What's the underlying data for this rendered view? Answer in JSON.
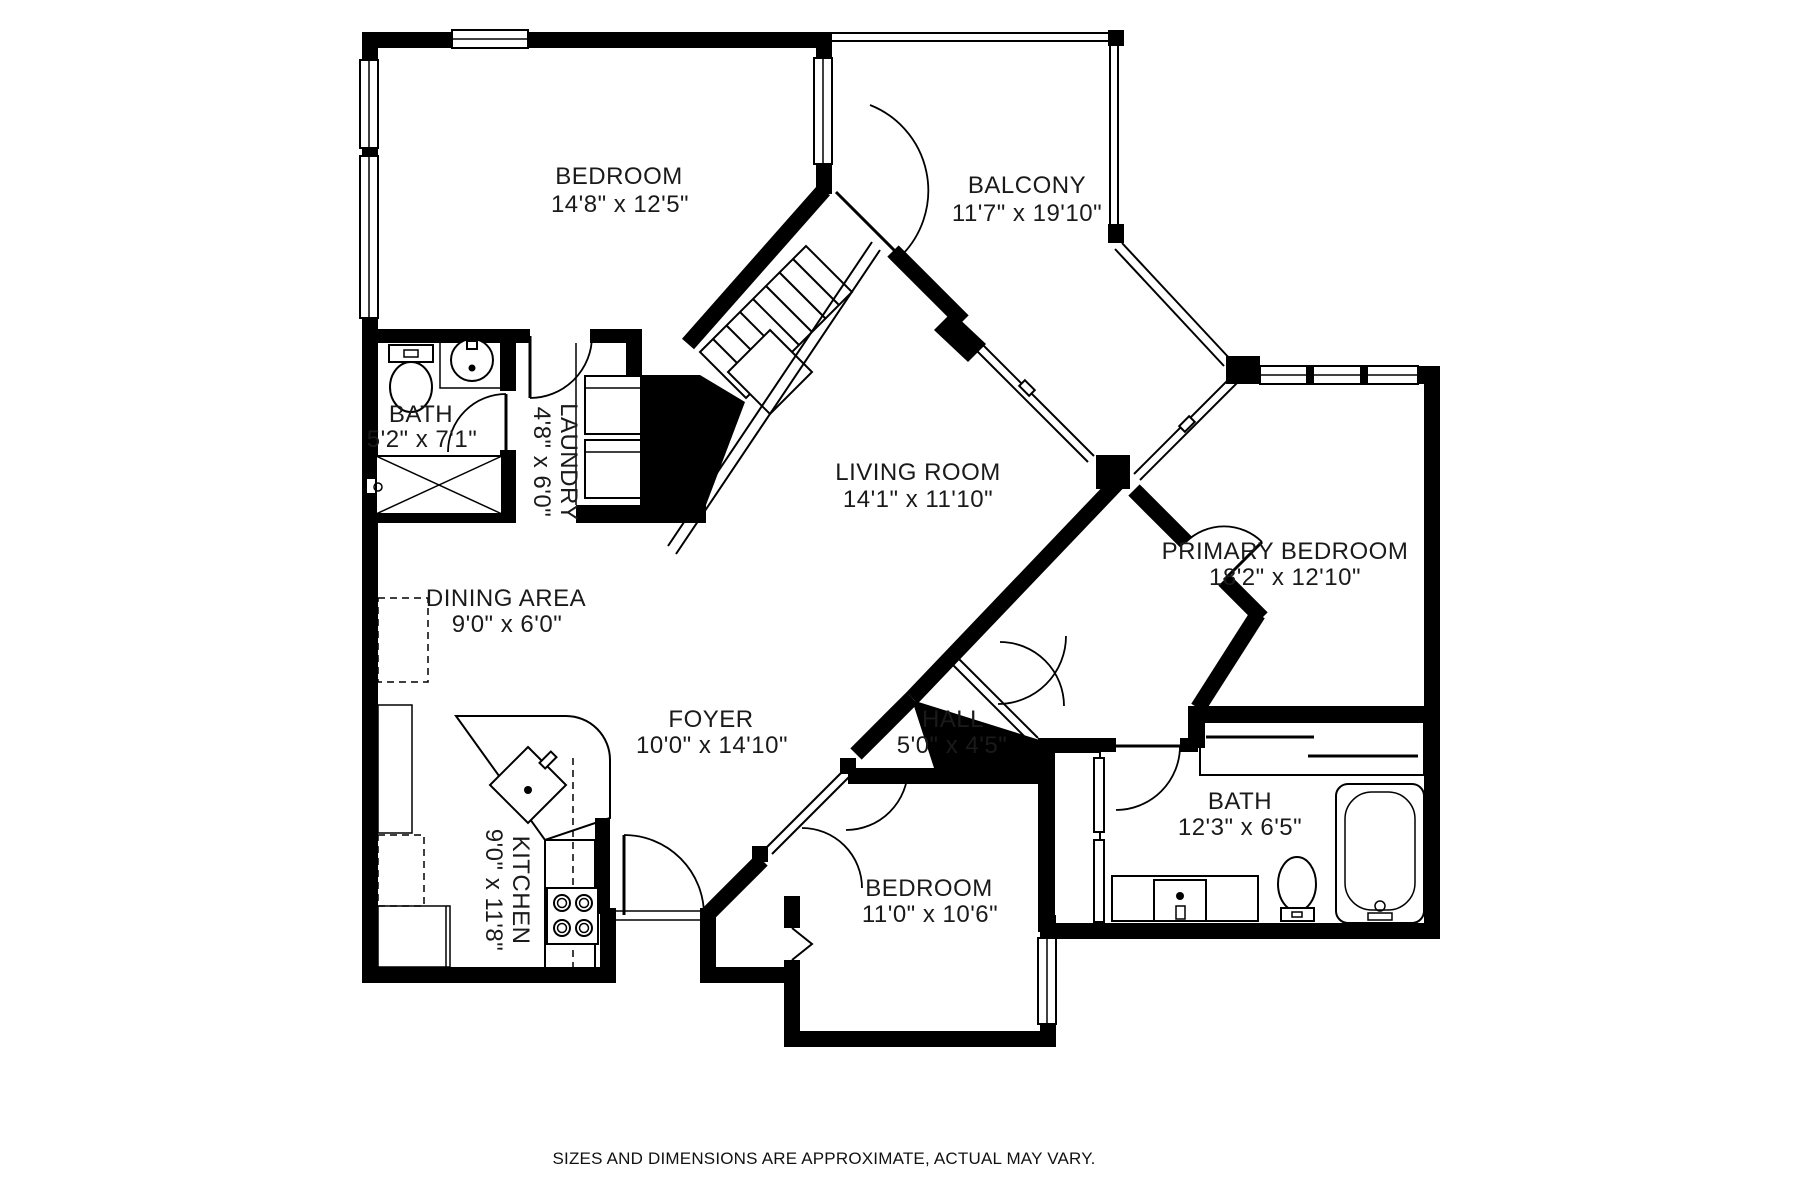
{
  "colors": {
    "background": "#ffffff",
    "walls": "#000000",
    "text": "#1a1a1a"
  },
  "rooms": {
    "bedroom1": {
      "name": "BEDROOM",
      "dims": "14'8\" x 12'5\""
    },
    "balcony": {
      "name": "BALCONY",
      "dims": "11'7\" x 19'10\""
    },
    "bath1": {
      "name": "BATH",
      "dims": "5'2\" x 7'1\""
    },
    "laundry": {
      "name": "LAUNDRY",
      "dims": "4'8\" x 6'0\""
    },
    "living_room": {
      "name": "LIVING ROOM",
      "dims": "14'1\" x 11'10\""
    },
    "primary_bedroom": {
      "name": "PRIMARY BEDROOM",
      "dims": "18'2\" x 12'10\""
    },
    "dining_area": {
      "name": "DINING AREA",
      "dims": "9'0\" x 6'0\""
    },
    "foyer": {
      "name": "FOYER",
      "dims": "10'0\" x 14'10\""
    },
    "hall": {
      "name": "HALL",
      "dims": "5'0\" x 4'5\""
    },
    "bath2": {
      "name": "BATH",
      "dims": "12'3\" x 6'5\""
    },
    "bedroom2": {
      "name": "BEDROOM",
      "dims": "11'0\" x 10'6\""
    },
    "kitchen": {
      "name": "KITCHEN",
      "dims": "9'0\" x 11'8\""
    }
  },
  "footer": {
    "disclaimer": "SIZES AND DIMENSIONS ARE APPROXIMATE, ACTUAL MAY VARY."
  }
}
